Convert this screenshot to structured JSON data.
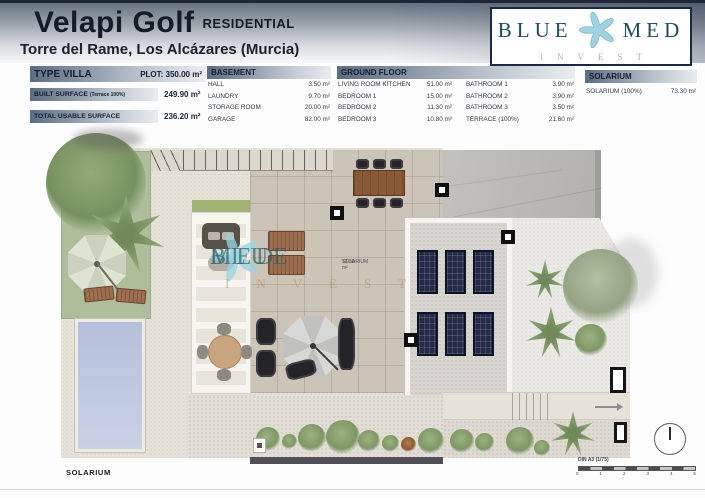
{
  "header": {
    "title": "Velapi Golf",
    "residential": "RESIDENTIAL",
    "subtitle": "Torre del Rame, Los Alcázares (Murcia)",
    "logo": {
      "word1": "BLUE",
      "word2": "MED",
      "sub": "INVEST",
      "starfish_icon": "starfish-icon",
      "text_color": "#1c4d57",
      "starfish_color": "#9ed3e0"
    }
  },
  "summary": {
    "type_label": "TYPE VILLA",
    "plot": "PLOT: 350.00 m²",
    "built_label": "BUILT SURFACE",
    "built_note": "(Terrace 100%)",
    "built_value": "249.90 m²",
    "usable_label": "TOTAL USABLE SURFACE",
    "usable_value": "236.20 m²"
  },
  "tables": {
    "basement": {
      "title": "BASEMENT",
      "rows": [
        {
          "label": "HALL",
          "value": "3.50 m²"
        },
        {
          "label": "LAUNDRY",
          "value": "9.70 m²"
        },
        {
          "label": "STORAGE ROOM",
          "value": "20.00 m²"
        },
        {
          "label": "GARAGE",
          "value": "82.00 m²"
        }
      ]
    },
    "ground_floor": {
      "title": "GROUND FLOOR",
      "col1": [
        {
          "label": "LIVING ROOM KITCHEN",
          "value": "51.00 m²"
        },
        {
          "label": "BEDROOM 1",
          "value": "15.00 m²"
        },
        {
          "label": "BEDROOM 2",
          "value": "11.30 m²"
        },
        {
          "label": "BEDROOM 3",
          "value": "10.80 m²"
        }
      ],
      "col2": [
        {
          "label": "BATHROOM 1",
          "value": "3.90 m²"
        },
        {
          "label": "BATHROOM 2",
          "value": "3.90 m²"
        },
        {
          "label": "BATHROOM 3",
          "value": "3.50 m²"
        },
        {
          "label": "TERRACE (100%)",
          "value": "21.60 m²"
        }
      ]
    },
    "solarium": {
      "title": "SOLARIUM",
      "rows": [
        {
          "label": "SOLARIUM (100%)",
          "value": "73.30 m²"
        }
      ]
    }
  },
  "plan": {
    "floor_label": "SOLARIUM",
    "room_label": {
      "name": "SOLARIUM",
      "area": "73.30 m²"
    },
    "watermark": {
      "word1": "BLUE",
      "word2": "MED",
      "sub": "INVEST"
    },
    "scale": {
      "label": "DIN A3 (1/75)",
      "ticks": [
        "0",
        "1",
        "2",
        "3",
        "4",
        "5"
      ]
    },
    "feature_icons": [
      "pool",
      "garden-tree-icon",
      "palm-tree-icon",
      "parasol-icon",
      "sun-lounger-icon",
      "pergola",
      "dining-table-icon",
      "solar-panel-icon",
      "roof",
      "stairs",
      "north-arrow-icon"
    ],
    "colors": {
      "pool": "#bcc6de",
      "garden": "#aebe9b",
      "tiles": "#ccc5b7",
      "solar_panel": "#242b49",
      "roof": "#bcbab6"
    }
  }
}
